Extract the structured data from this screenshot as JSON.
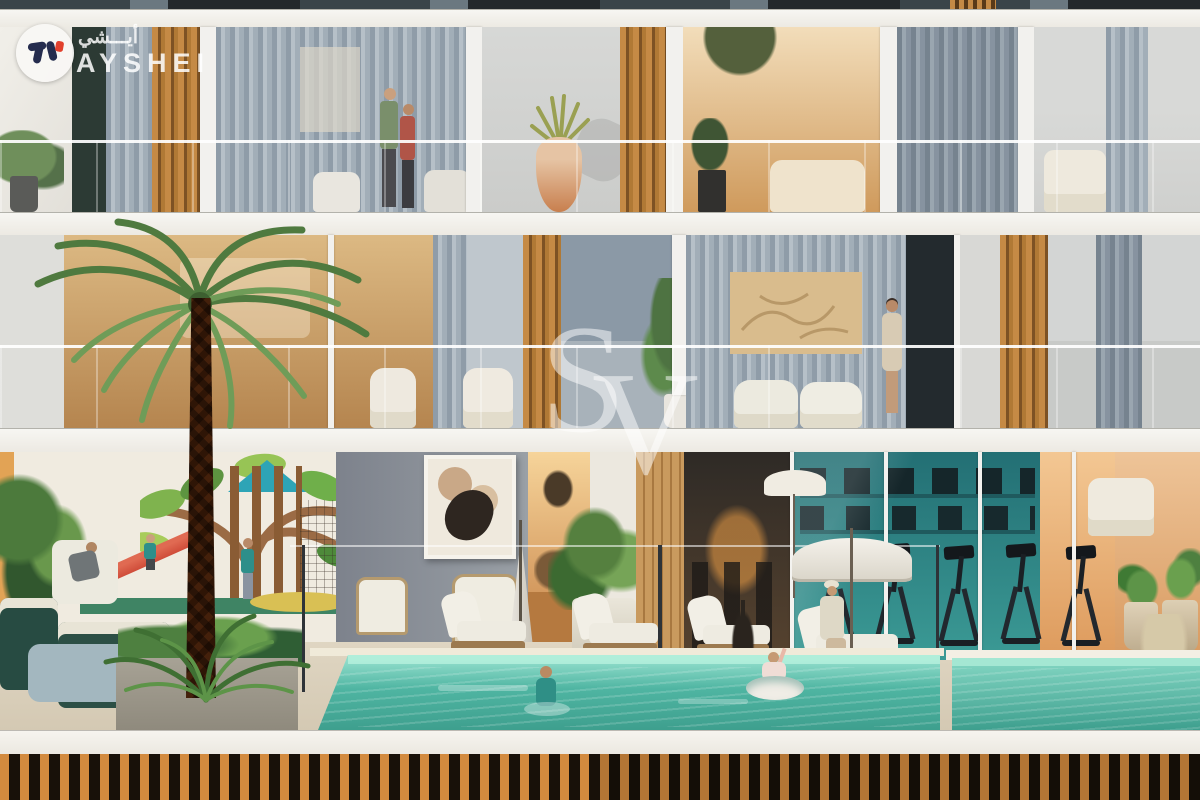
{
  "meta": {
    "description": "Architectural rendering of a residential building facade with balconies, swimming pool, gym and kids play area"
  },
  "watermarks": {
    "logo": {
      "brand_arabic": "أيـــشي",
      "brand_latin": "AYSHEI"
    },
    "monogram": {
      "letter_s": "S",
      "letter_v": "V"
    }
  },
  "palette": {
    "slab_white": "#f4f3ef",
    "curtain_gray": "#9aa7b2",
    "wood_slat_orange": "#c58a45",
    "base_slat_orange": "#d28a3e",
    "pool_turquoise": "#4fb5a2",
    "gym_teal": "#2b7f82",
    "warm_interior_gold": "#e3b87e",
    "mural_leaf_green": "#7fb34e",
    "slide_red": "#cf4c39",
    "deck_sand": "#ddd3c0",
    "logo_navy": "#252c4e",
    "logo_red": "#e2402d"
  },
  "scene": {
    "upper_floor": [
      "couple-on-balcony",
      "gray-curtains",
      "wood-slat-screens",
      "terracotta-vase-plant",
      "warm-living-room",
      "cream-armchair"
    ],
    "middle_floor": [
      "date-palm",
      "gold-relief-art",
      "white-lounge-chairs",
      "woman-on-balcony",
      "potted-tree"
    ],
    "ground_floor": [
      "kids-playground-mural",
      "red-slide",
      "outdoor-lounge-sofas",
      "abstract-wall-art",
      "closed-umbrella",
      "indoor-cafe",
      "fitness-gym",
      "cardio-machines",
      "pool-deck-loungers",
      "open-umbrella",
      "swimming-pool",
      "spa-pool",
      "swimmers",
      "potted-plants"
    ],
    "base": [
      "wood-slat-fence"
    ]
  }
}
